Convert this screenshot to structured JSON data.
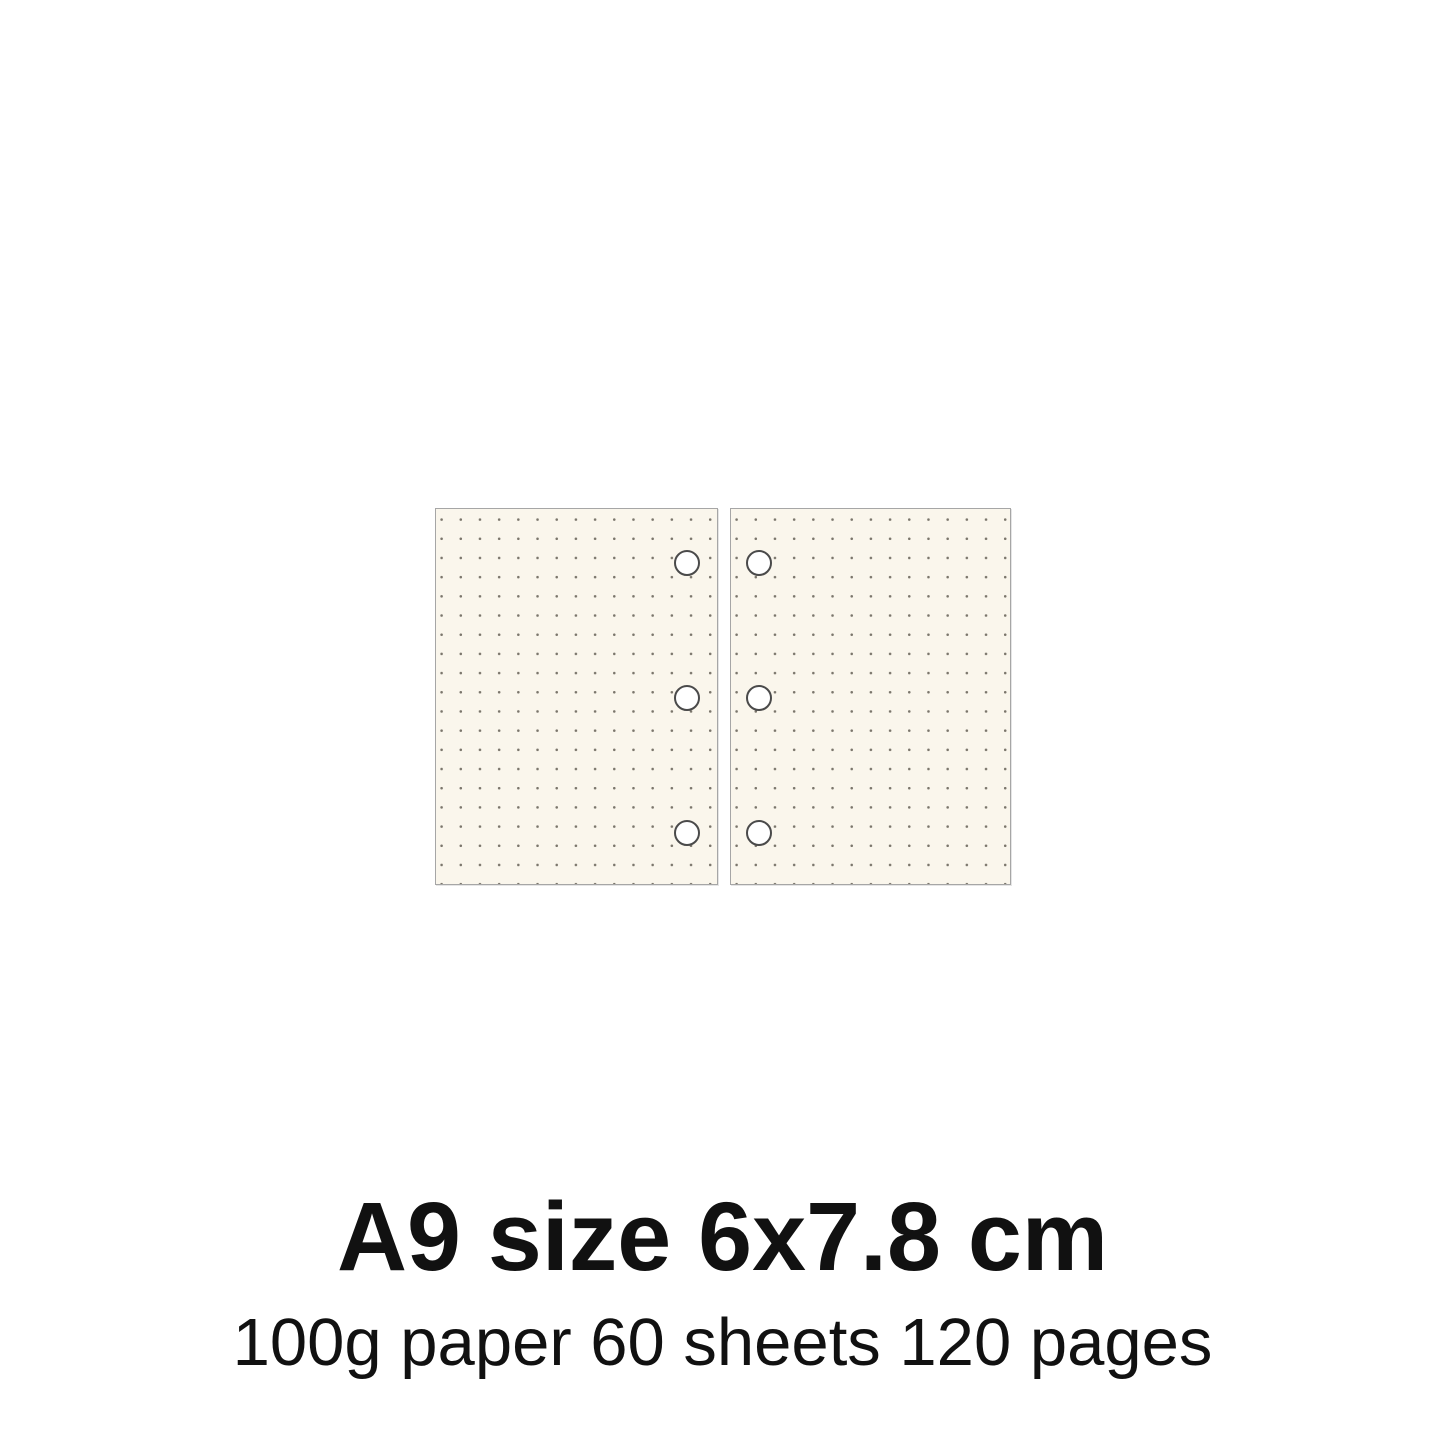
{
  "product": {
    "title": "A9 size 6x7.8 cm",
    "subtitle": "100g paper 60 sheets 120 pages"
  },
  "sheets": {
    "count": 2,
    "pattern": "dot-grid",
    "holes_per_sheet": 3
  },
  "colors": {
    "background": "#ffffff",
    "paper": "#faf6ec",
    "dot": "#7b766c",
    "sheet_border": "#a6a6a6",
    "hole_border": "#4a4a4a",
    "hole_fill": "#ffffff",
    "text": "#111111"
  }
}
